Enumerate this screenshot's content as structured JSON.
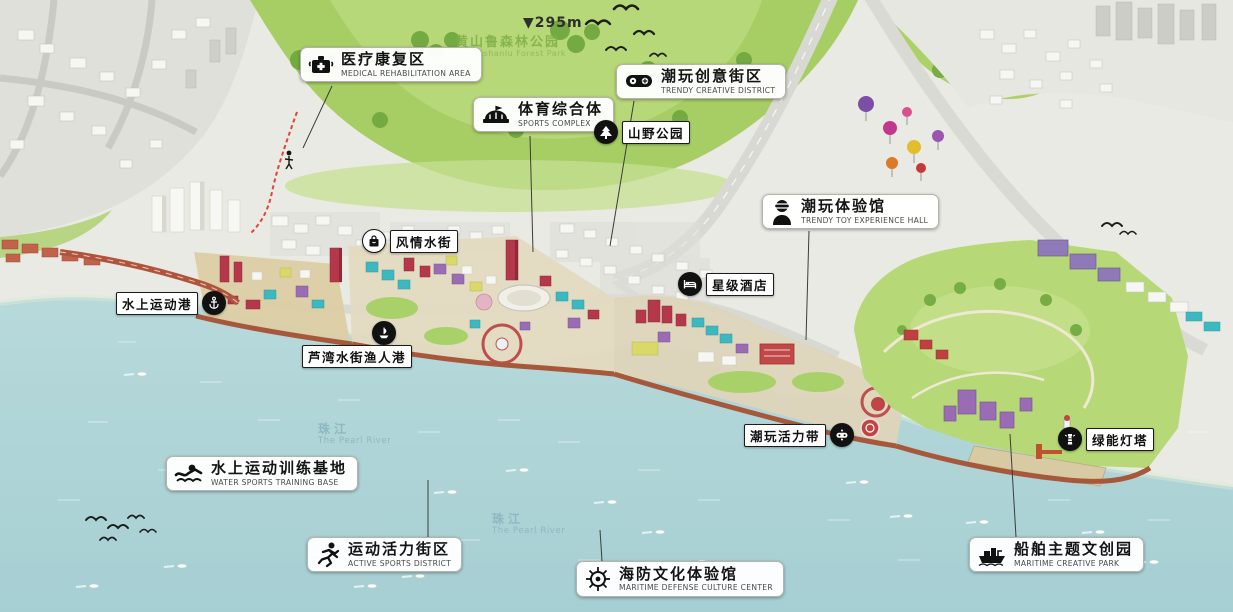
{
  "peak_marker": "▼295m",
  "forest_park": {
    "zh": "黄山鲁森林公园",
    "en": "Huangshanlu Forest Park"
  },
  "river_labels": [
    {
      "zh": "珠江",
      "en": "The Pearl River"
    },
    {
      "zh": "珠江",
      "en": "The Pearl River"
    }
  ],
  "callouts": {
    "medical": {
      "zh": "医疗康复区",
      "en": "MEDICAL REHABILITATION AREA",
      "icon": "medical-kit-icon"
    },
    "sports_complex": {
      "zh": "体育综合体",
      "en": "SPORTS COMPLEX",
      "icon": "stadium-icon"
    },
    "trendy_creative": {
      "zh": "潮玩创意街区",
      "en": "TRENDY CREATIVE DISTRICT",
      "icon": "game-controller-icon"
    },
    "trendy_toy": {
      "zh": "潮玩体验馆",
      "en": "TRENDY TOY EXPERIENCE HALL",
      "icon": "vr-headset-icon"
    },
    "water_training": {
      "zh": "水上运动训练基地",
      "en": "WATER SPORTS TRAINING BASE",
      "icon": "swimmer-icon"
    },
    "active_sports": {
      "zh": "运动活力街区",
      "en": "ACTIVE SPORTS DISTRICT",
      "icon": "runner-icon"
    },
    "maritime_defense": {
      "zh": "海防文化体验馆",
      "en": "MARITIME DEFENSE CULTURE CENTER",
      "icon": "ship-helm-icon"
    },
    "maritime_creative": {
      "zh": "船舶主题文创园",
      "en": "MARITIME CREATIVE PARK",
      "icon": "ship-icon"
    }
  },
  "tags": {
    "mountain_park": {
      "zh": "山野公园",
      "icon": "tree-icon"
    },
    "star_hotel": {
      "zh": "星级酒店",
      "icon": "bed-icon"
    },
    "water_street": {
      "zh": "风情水街",
      "icon": "shopping-bag-icon"
    },
    "water_sports_port": {
      "zh": "水上运动港",
      "icon": "anchor-icon"
    },
    "fisherman_port": {
      "zh": "芦湾水街渔人港",
      "icon": "boat-icon"
    },
    "vitality_belt": {
      "zh": "潮玩活力带",
      "icon": "joystick-icon"
    },
    "green_lighthouse": {
      "zh": "绿能灯塔",
      "icon": "lighthouse-icon"
    }
  },
  "colors": {
    "water": "#b7dbdc",
    "hills": "#a7ce64",
    "urban": "#eaeae4",
    "promenade": "#a8583a",
    "accent_red": "#b5384a",
    "accent_purple": "#9a6cb4",
    "accent_teal": "#3eb8c0",
    "accent_yellow": "#d9d868",
    "park_green": "#b6d877",
    "trail_red": "#e04438"
  }
}
